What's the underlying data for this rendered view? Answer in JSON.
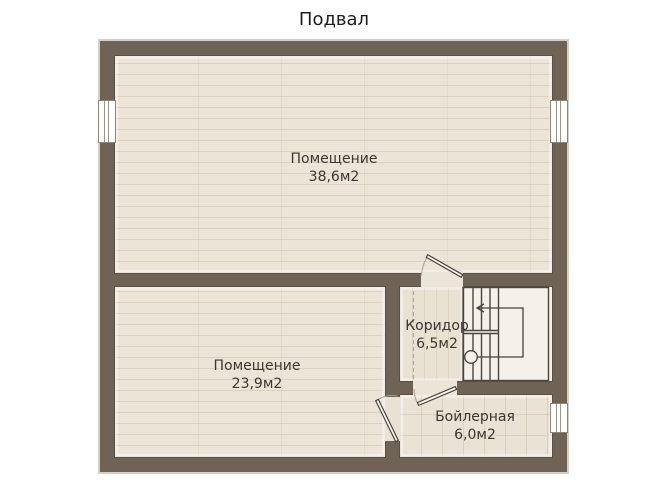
{
  "title": "Подвал",
  "floor_plan": {
    "rooms": [
      {
        "name": "Помещение",
        "area": "38,6м2"
      },
      {
        "name": "Помещение",
        "area": "23,9м2"
      },
      {
        "name": "Коридор",
        "area": "6,5м2"
      },
      {
        "name": "Бойлерная",
        "area": "6,0м2"
      }
    ],
    "symbols": {
      "staircase": "u-shaped staircase with walk line, start circle and up-arrow",
      "windows_count": 3,
      "doors_count": 3
    },
    "colors": {
      "wall": "#6e6355",
      "floor_plank": "#ece4d6",
      "floor_tile": "#eae2d4",
      "stairs_floor": "#f5f1e8",
      "line": "#4c453d",
      "page_background": "#ffffff"
    }
  }
}
